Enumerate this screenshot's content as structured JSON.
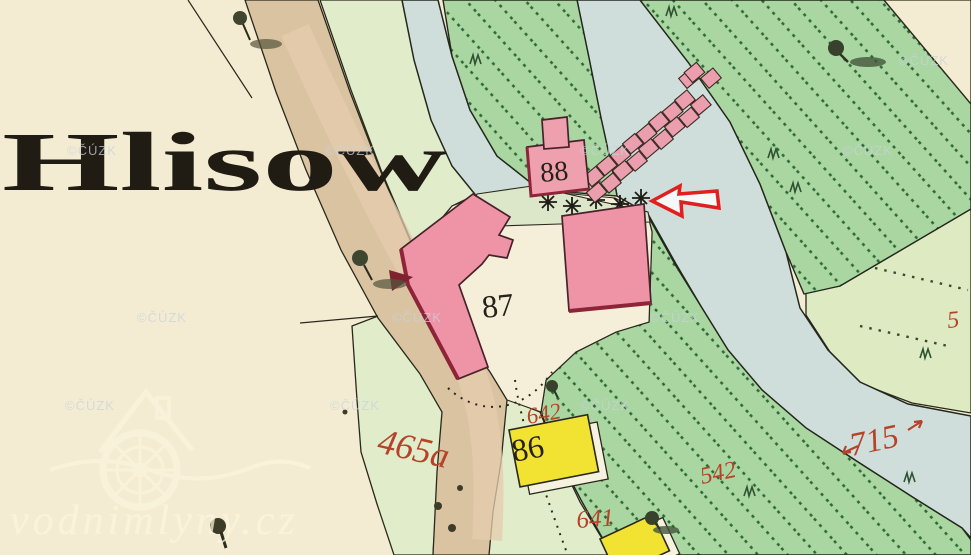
{
  "map": {
    "kind": "historical cadastral map screenshot",
    "place_label": "Hlisow",
    "building_labels": {
      "b88": "88",
      "b87": "87",
      "b86": "86"
    },
    "parcel_labels": {
      "p465a": "465a",
      "p642": "642",
      "p641": "641",
      "p542": "542",
      "p715": "715",
      "p5": "5"
    },
    "watermark": {
      "text": "©ČÚZK"
    },
    "site_watermark": {
      "text": "vodnimlyny.cz"
    },
    "colors": {
      "paper_cream": "#f4ecd2",
      "pale_green": "#e0ecca",
      "meadow_green": "#a9d6a1",
      "hatch_green": "#2e6837",
      "water_blue": "#cfdeda",
      "road_tan": "#d9c3a1",
      "building_pink": "#ef94a6",
      "building_shadow_red": "#8d2437",
      "wood_yellow": "#f2e232",
      "parcel_number_red": "#b5432a",
      "annotation_arrow_red": "#e01f1f",
      "ink_black": "#26241a"
    }
  }
}
